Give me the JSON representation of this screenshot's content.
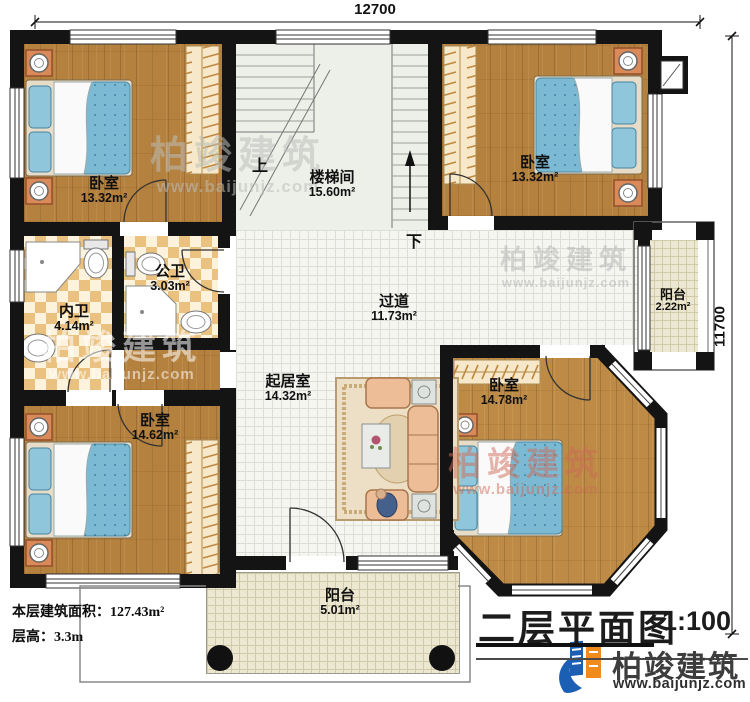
{
  "drawing": {
    "title": "二层平面图",
    "scale": "1:100",
    "floor_area_label": "本层建筑面积：127.43m²",
    "floor_height_label": "层高：3.3m"
  },
  "dimensions": {
    "width_top": "12700",
    "height_right": "11700"
  },
  "rooms": {
    "bedroom_tl": {
      "name": "卧室",
      "area": "13.32m²"
    },
    "stair": {
      "name": "楼梯间",
      "area": "15.60m²"
    },
    "bedroom_tr": {
      "name": "卧室",
      "area": "13.32m²"
    },
    "bath_inner": {
      "name": "内卫",
      "area": "4.14m²"
    },
    "bath_public": {
      "name": "公卫",
      "area": "3.03m²"
    },
    "hallway": {
      "name": "过道",
      "area": "11.73m²"
    },
    "balcony_right": {
      "name": "阳台",
      "area": "2.22m²"
    },
    "living": {
      "name": "起居室",
      "area": "14.32m²"
    },
    "bedroom_br": {
      "name": "卧室",
      "area": "14.78m²"
    },
    "bedroom_bl": {
      "name": "卧室",
      "area": "14.62m²"
    },
    "balcony_bottom": {
      "name": "阳台",
      "area": "5.01m²"
    }
  },
  "stair_marks": {
    "up": "上",
    "down": "下"
  },
  "brand": {
    "name": "柏竣建筑",
    "website": "www.baijunjz.com"
  },
  "watermark": {
    "text": "柏竣建筑",
    "url": "www.baijunjz.com"
  },
  "colors": {
    "wall": "#141414",
    "wood": "#b5813e",
    "bed": "#7cb9d2",
    "accent_orange": "#da8a58"
  }
}
